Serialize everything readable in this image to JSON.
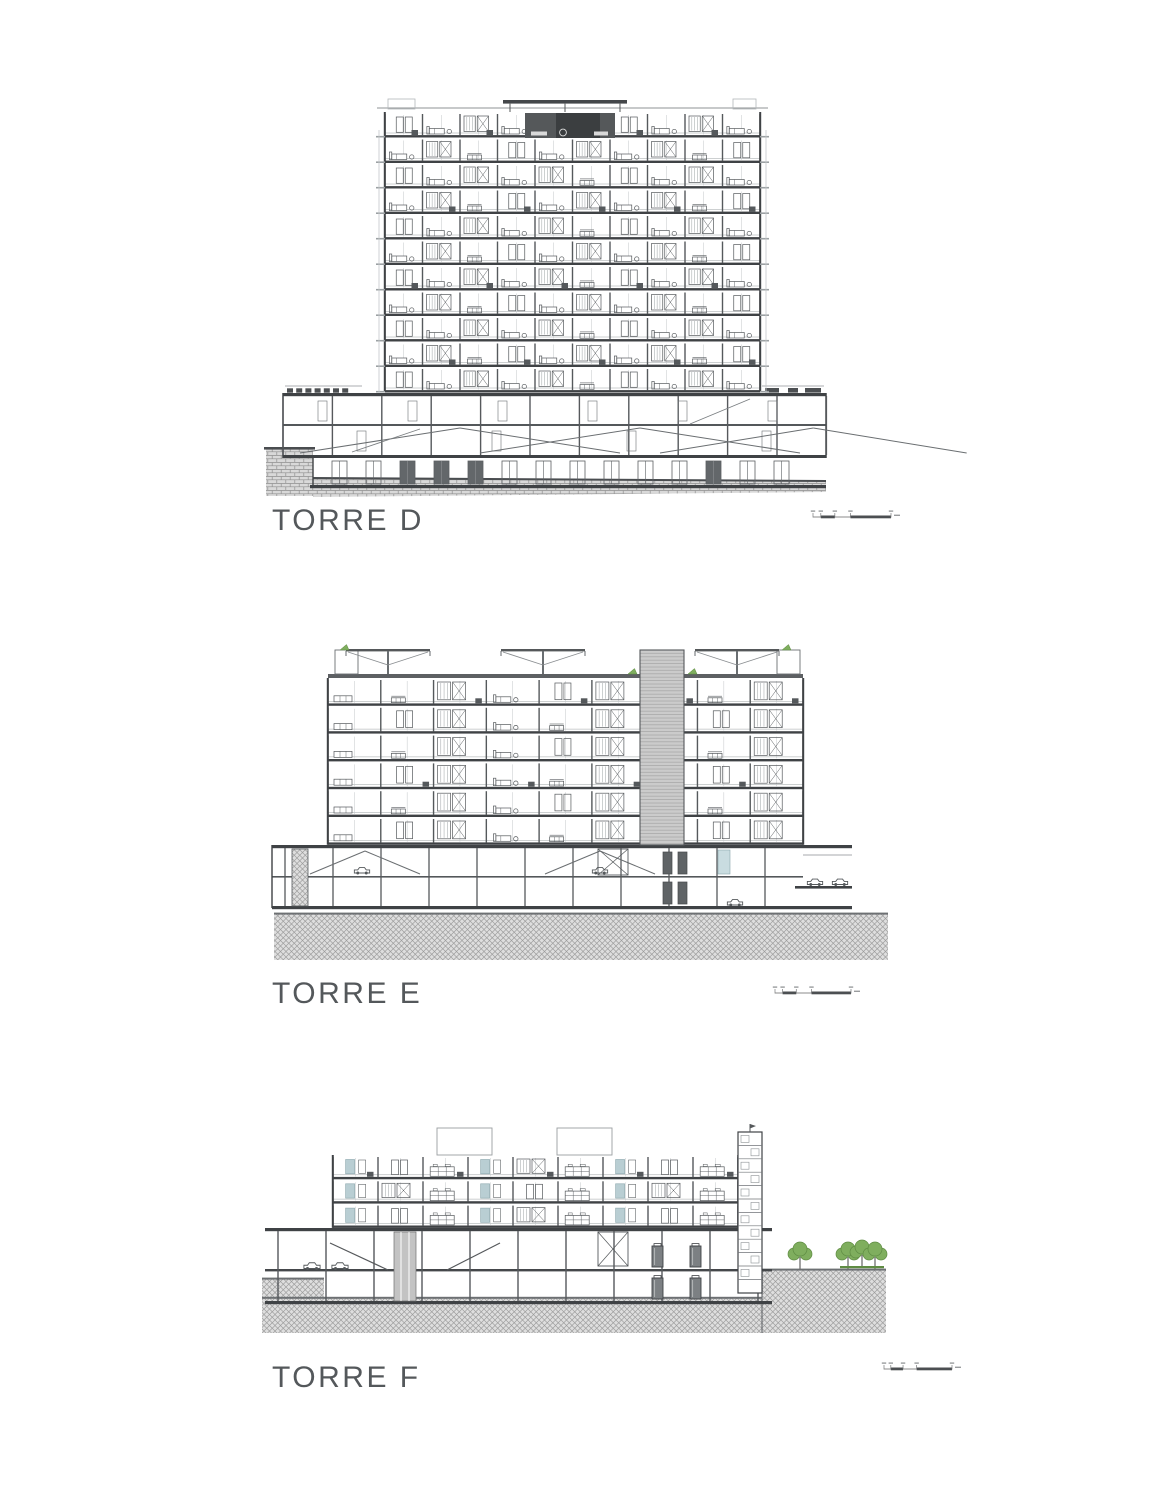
{
  "sheet": {
    "background": "#ffffff",
    "content": "Architectural building sections sheet"
  },
  "buildings": [
    {
      "id": "torre-d",
      "label": "TORRE D",
      "kind": "building section",
      "tower_floors": 11,
      "tower_bays": 10,
      "podium_levels": 2,
      "basement_level": 1,
      "dark_penthouse_on_top": true,
      "roof_canopy": true,
      "ground_hatch": "brick",
      "scale_bar_graphic": true
    },
    {
      "id": "torre-e",
      "label": "TORRE E",
      "kind": "building section",
      "floors": 6,
      "bays": 9,
      "core_shaft_above_roof": true,
      "roof_shade_structures": 3,
      "roof_boxes": 2,
      "roof_plants": 4,
      "podium_levels": 2,
      "parking_ramps": 2,
      "cars": 5,
      "ground_hatch": "crosshatch",
      "scale_bar_graphic": true
    },
    {
      "id": "torre-f",
      "label": "TORRE F",
      "kind": "building section",
      "floors": 3,
      "bays": 9,
      "rooftop_volumes": 2,
      "stair_tower_right": true,
      "trees_right": 4,
      "podium_levels": 2,
      "water_tanks": 4,
      "cars": 2,
      "ground_hatch": "crosshatch",
      "scale_bar_graphic": true
    }
  ],
  "icons": {
    "car": "car-icon",
    "tree": "tree-icon",
    "shade_structure": "shade-structure-icon",
    "plant_wedge": "roof-plant-icon"
  },
  "colors": {
    "line_dark": "#3f4245",
    "line_mid": "#55595c",
    "line_light": "#9ba0a3",
    "faint": "#c3c7ca",
    "dark_fill": "#55585a",
    "darker_fill": "#3b3e40",
    "shaft_fill": "#cbcbcb",
    "hatch_bg": "#dedede",
    "hatch_line": "#9b9b9b",
    "brick_bg": "#d9d9d9",
    "brick_line": "#8f8f8f",
    "teal": "#b9ced3",
    "teal_stroke": "#8aa6ac",
    "green": "#7fae5e",
    "green_dark": "#5f8c43",
    "label_text": "#54585b",
    "scalebar": "#4c4f52"
  }
}
